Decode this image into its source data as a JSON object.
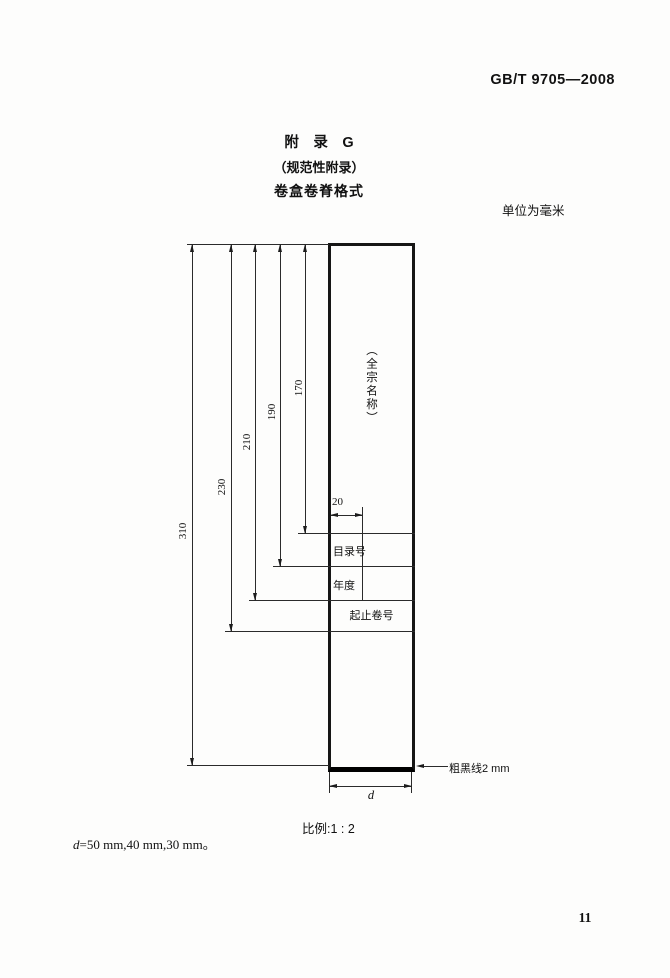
{
  "header": {
    "doc_code": "GB/T 9705—2008"
  },
  "appendix": {
    "title_line1": "附　录　G",
    "title_line2": "（规范性附录）",
    "title_line3": "卷盒卷脊格式",
    "units_note": "单位为毫米"
  },
  "diagram": {
    "spine_name_vertical": "（全宗名称）",
    "dim_heights": [
      "310",
      "230",
      "210",
      "190",
      "170"
    ],
    "dim_width_20": "20",
    "row_labels": [
      "目录号",
      "年度",
      "起止卷号"
    ],
    "width_var_label": "d",
    "thick_line_note": "粗黑线2 mm",
    "scale_note": "比例:1 : 2"
  },
  "footnote": {
    "var": "d",
    "text": "=50 mm,40 mm,30 mm。"
  },
  "footer": {
    "page_number": "11"
  }
}
